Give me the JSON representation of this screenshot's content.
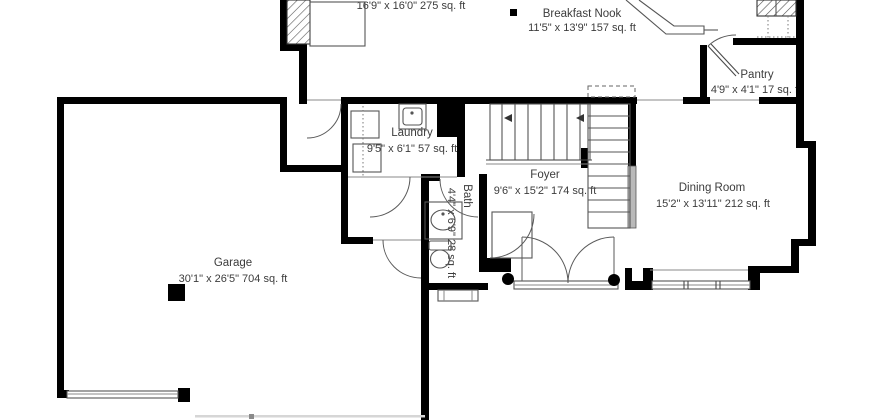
{
  "floor_plan": {
    "type": "residential-first-floor-plan",
    "colors": {
      "background": "#ffffff",
      "walls": "#000000",
      "half_wall": "#b9b9b9",
      "labels": "#3c3c3c",
      "fixture_lines": "#555555"
    },
    "rooms": {
      "upper_room": {
        "dims": "16'9\" x 16'0\" 275 sq. ft"
      },
      "breakfast_nook": {
        "name": "Breakfast Nook",
        "dims": "11'5\" x 13'9\" 157 sq. ft"
      },
      "pantry": {
        "name": "Pantry",
        "dims": "4'9\" x 4'1\" 17 sq. ft"
      },
      "laundry": {
        "name": "Laundry",
        "dims": "9'5\" x 6'1\" 57 sq. ft"
      },
      "foyer": {
        "name": "Foyer",
        "dims": "9'6\" x 15'2\" 174 sq. ft"
      },
      "dining_room": {
        "name": "Dining Room",
        "dims": "15'2\" x 13'11\" 212 sq. ft"
      },
      "bath": {
        "name": "Bath",
        "dims": "4'4\" x 6'9\" 28 sq. ft"
      },
      "garage": {
        "name": "Garage",
        "dims": "30'1\" x 26'5\" 704 sq. ft"
      }
    }
  }
}
